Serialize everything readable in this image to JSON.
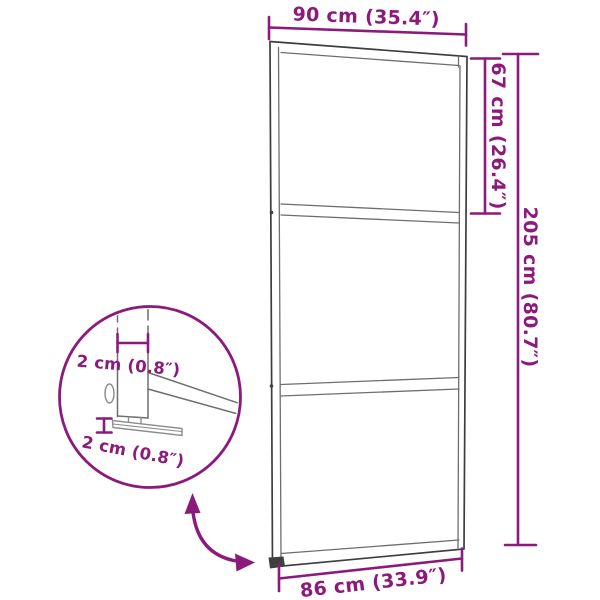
{
  "palette": {
    "accent": "#8b1a7c",
    "frame_dark": "#3d3d3d",
    "frame_mid": "#6e6e6e",
    "frame_light": "#8c8c8c",
    "background": "#ffffff"
  },
  "dimensions": {
    "top_width": "90 cm (35.4″)",
    "upper_section_height": "67 cm (26.4″)",
    "total_height": "205 cm (80.7″)",
    "bottom_width": "86 cm (33.9″)",
    "detail_frame_width": "2 cm (0.8″)",
    "detail_frame_thickness": "2 cm (0.8″)"
  }
}
